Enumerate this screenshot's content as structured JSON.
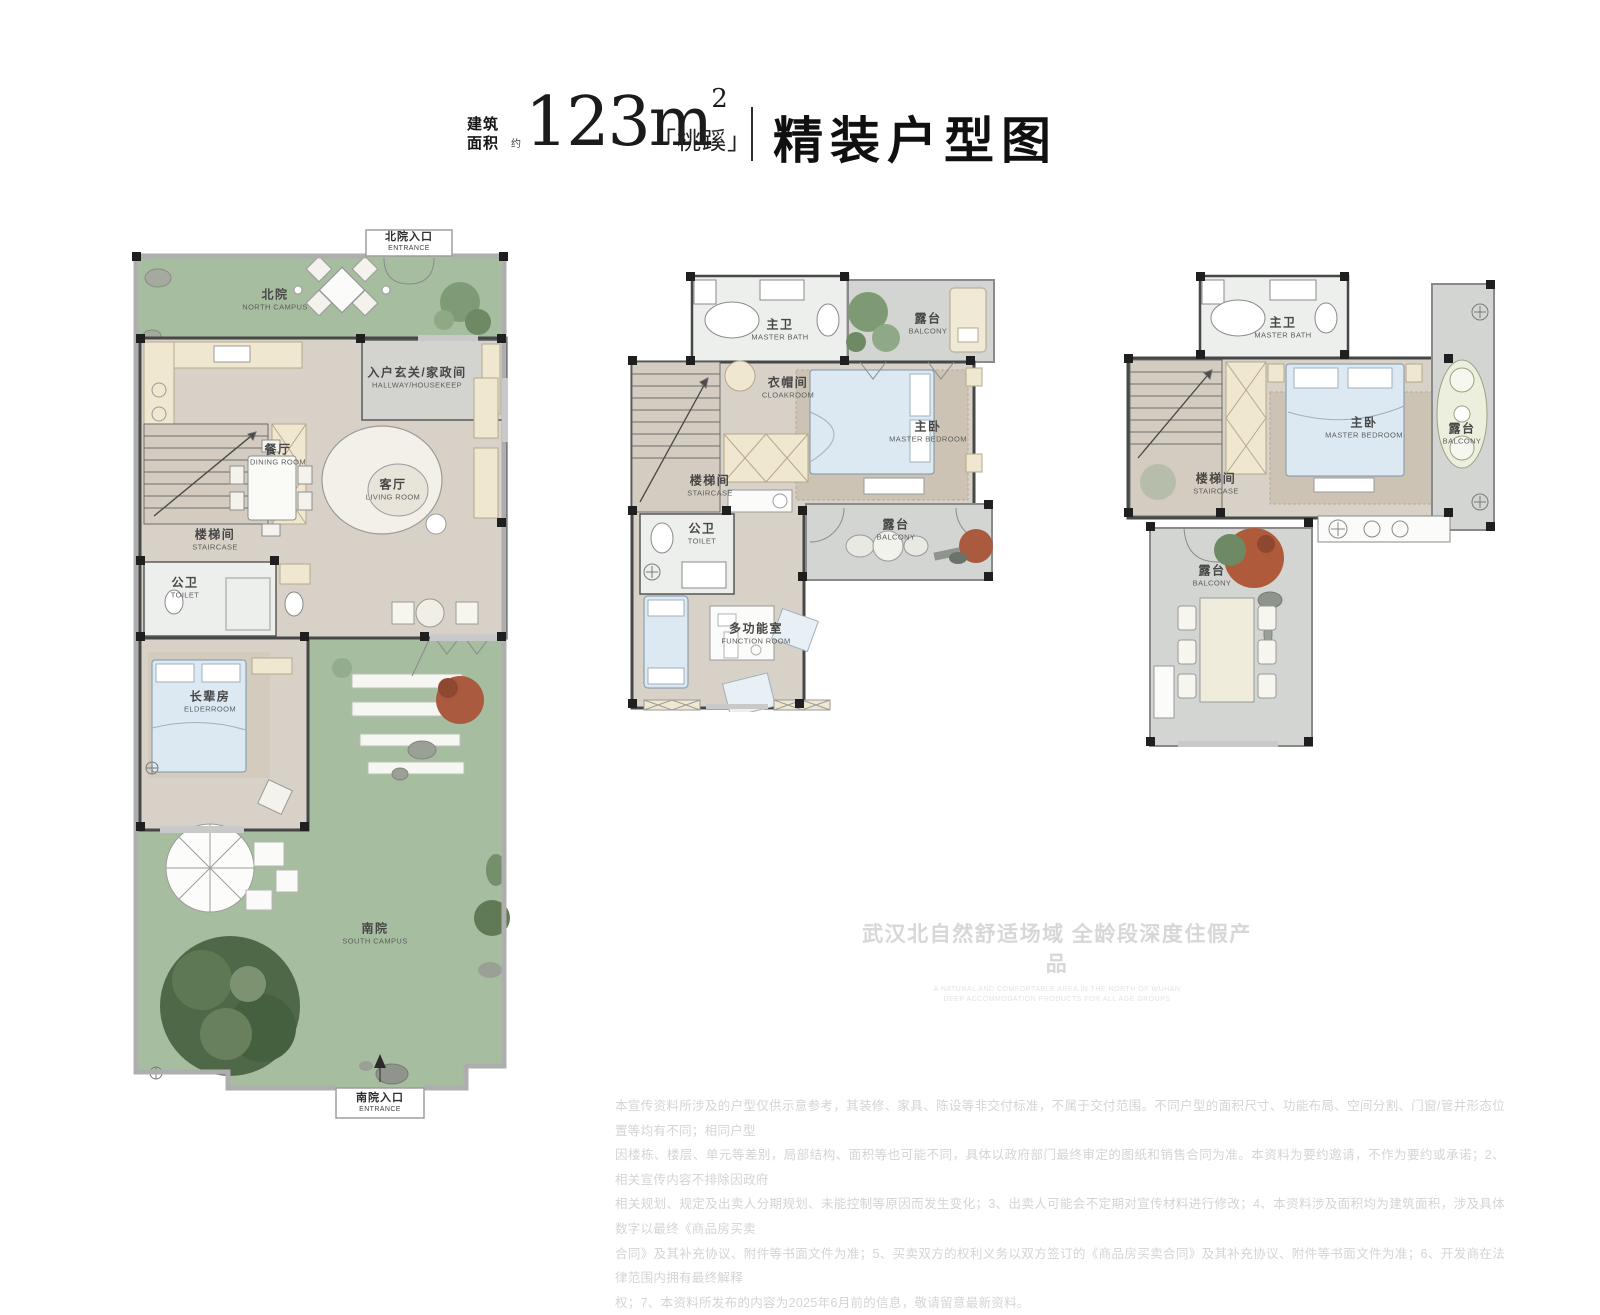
{
  "header": {
    "area_label_line1": "建筑",
    "area_label_line2": "面积",
    "approx": "约",
    "area_value": "123",
    "area_unit": "m",
    "area_sup": "2",
    "product_name": "「桃蹊」",
    "title": "精装户型图"
  },
  "palette": {
    "yard_green": "#a7bda0",
    "floor_beige": "#d8d1c7",
    "balcony_gray": "#d2d5d1",
    "bath_white": "#edefed",
    "wall_dark": "#474747",
    "cabinet_cream": "#efe7d0",
    "bed_blue": "#dce9f2",
    "tree_green": "#4f6847",
    "shrub_red": "#aa5a3e"
  },
  "plans": {
    "first_floor": {
      "entrance_top": {
        "zh": "北院入口",
        "en": "ENTRANCE"
      },
      "entrance_bottom": {
        "zh": "南院入口",
        "en": "ENTRANCE"
      },
      "rooms": {
        "north_yard": {
          "zh": "北院",
          "en": "NORTH CAMPUS"
        },
        "hallway": {
          "zh": "入户玄关/家政间",
          "en": "HALLWAY/HOUSEKEEP"
        },
        "dining": {
          "zh": "餐厅",
          "en": "DINING ROOM"
        },
        "living": {
          "zh": "客厅",
          "en": "LIVING ROOM"
        },
        "staircase": {
          "zh": "楼梯间",
          "en": "STAIRCASE"
        },
        "toilet": {
          "zh": "公卫",
          "en": "TOILET"
        },
        "elder": {
          "zh": "长辈房",
          "en": "ELDERROOM"
        },
        "south_yard": {
          "zh": "南院",
          "en": "SOUTH CAMPUS"
        }
      }
    },
    "second_floor": {
      "rooms": {
        "master_bath": {
          "zh": "主卫",
          "en": "MASTER BATH"
        },
        "balcony_top": {
          "zh": "露台",
          "en": "BALCONY"
        },
        "cloakroom": {
          "zh": "衣帽间",
          "en": "CLOAKROOM"
        },
        "master_bedroom": {
          "zh": "主卧",
          "en": "MASTER BEDROOM"
        },
        "staircase": {
          "zh": "楼梯间",
          "en": "STAIRCASE"
        },
        "toilet": {
          "zh": "公卫",
          "en": "TOILET"
        },
        "balcony_mid": {
          "zh": "露台",
          "en": "BALCONY"
        },
        "function_room": {
          "zh": "多功能室",
          "en": "FUNCTION ROOM"
        }
      }
    },
    "third_floor": {
      "rooms": {
        "master_bath": {
          "zh": "主卫",
          "en": "MASTER BATH"
        },
        "master_bedroom": {
          "zh": "主卧",
          "en": "MASTER BEDROOM"
        },
        "balcony_right": {
          "zh": "露台",
          "en": "BALCONY"
        },
        "staircase": {
          "zh": "楼梯间",
          "en": "STAIRCASE"
        },
        "balcony_bottom": {
          "zh": "露台",
          "en": "BALCONY"
        }
      }
    }
  },
  "watermark": {
    "zh": "武汉北自然舒适场域 全龄段深度住假产品",
    "en_line1": "A NATURAL AND COMFORTABLE AREA IN THE NORTH OF WUHAN",
    "en_line2": "DEEP ACCOMMODATION PRODUCTS FOR ALL AGE GROUPS"
  },
  "disclaimer": {
    "lines": [
      "本宣传资料所涉及的户型仅供示意参考，其装修、家具、陈设等非交付标准，不属于交付范围。不同户型的面积尺寸、功能布局、空间分割、门窗/管井形态位置等均有不同；相同户型",
      "因楼栋、楼层、单元等差别，局部结构、面积等也可能不同，具体以政府部门最终审定的图纸和销售合同为准。本资料为要约邀请，不作为要约或承诺；2、相关宣传内容不排除因政府",
      "相关规划、规定及出卖人分期规划、未能控制等原因而发生变化；3、出卖人可能会不定期对宣传材料进行修改；4、本资料涉及面积均为建筑面积，涉及具体数字以最终《商品房买卖",
      "合同》及其补充协议、附件等书面文件为准；5、买卖双方的权利义务以双方签订的《商品房买卖合同》及其补充协议、附件等书面文件为准；6、开发商在法律范围内拥有最终解释",
      "权；7、本资料所发布的内容为2025年6月前的信息，敬请留意最新资料。"
    ]
  }
}
